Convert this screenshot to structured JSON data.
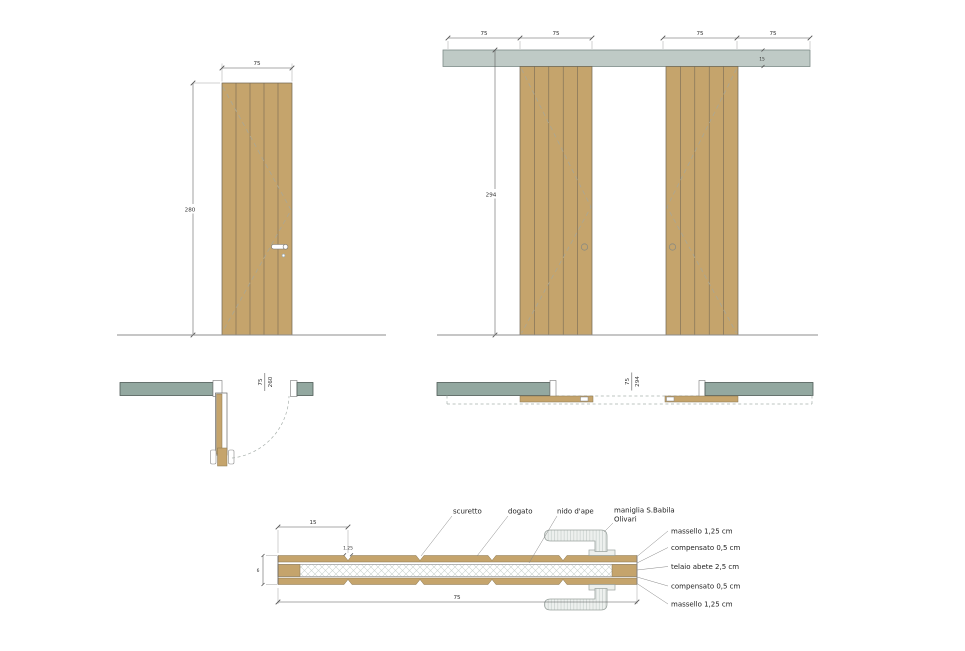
{
  "drawing": {
    "colors": {
      "wood": "#C5A46C",
      "wall": "#93A8A0",
      "track": "#BFCAC6"
    },
    "elevation_single": {
      "width_dim": "75",
      "height_dim": "280"
    },
    "elevation_double": {
      "panel_dims": [
        "75",
        "75",
        "75",
        "75"
      ],
      "height_dim": "294",
      "track_height_dim": "15"
    },
    "plan_single": {
      "opening_width": "75",
      "opening_height": "260"
    },
    "plan_double": {
      "opening_width": "75",
      "opening_height": "294"
    },
    "section": {
      "plank_width_dim": "15",
      "groove_dim": "1.25",
      "thickness_dim": "6",
      "width_dim": "75",
      "callout_scuretto": "scuretto",
      "callout_dogato": "dogato",
      "callout_nido": "nido d'ape",
      "callout_maniglia_line1": "maniglia S.Babila",
      "callout_maniglia_line2": "Olivari",
      "layer_massello_top": "massello 1,25 cm",
      "layer_compensato_top": "compensato 0,5 cm",
      "layer_telaio": "telaio abete 2,5 cm",
      "layer_compensato_bottom": "compensato 0,5 cm",
      "layer_massello_bottom": "massello 1,25 cm"
    }
  }
}
